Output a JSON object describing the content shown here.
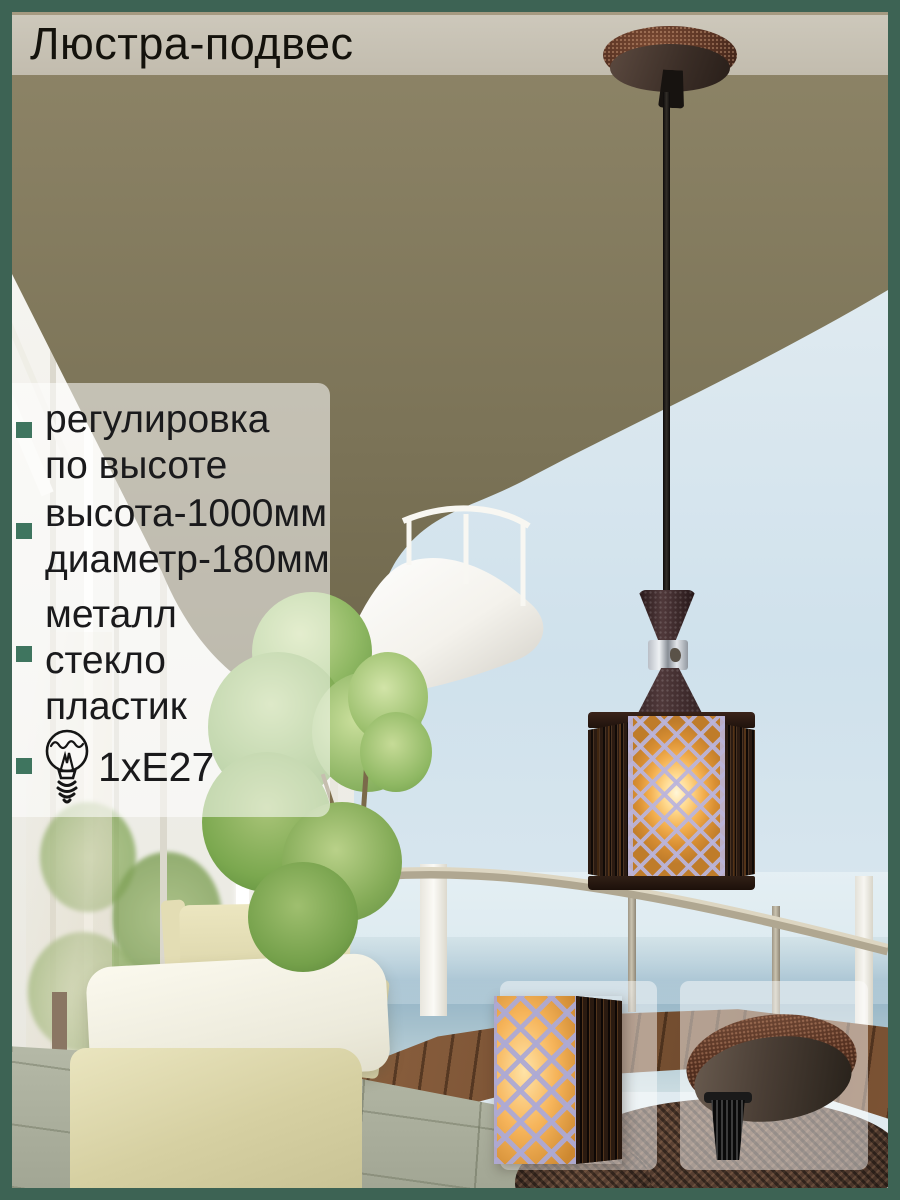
{
  "header": {
    "title": "Люстра-подвес"
  },
  "specs": {
    "items": [
      {
        "lines": [
          "регулировка",
          "по высоте"
        ]
      },
      {
        "lines": [
          "высота-1000мм",
          "диаметр-180мм"
        ]
      },
      {
        "lines": [
          "металл",
          "стекло",
          "пластик"
        ]
      },
      {
        "icon": "light-bulb-icon",
        "label": "1xE27"
      }
    ]
  },
  "colors": {
    "frame_green": "#3d6354",
    "bullet_green": "#3f755f",
    "bar_bg": "#c7c1b3",
    "title_color": "#14120c",
    "text_color": "#1a1a1c",
    "ceiling_olive": "#7b7357",
    "lamp_copper": "#5a3424",
    "lamp_glow": "#f2ae4e",
    "lattice_lavender": "#ada9d4"
  }
}
